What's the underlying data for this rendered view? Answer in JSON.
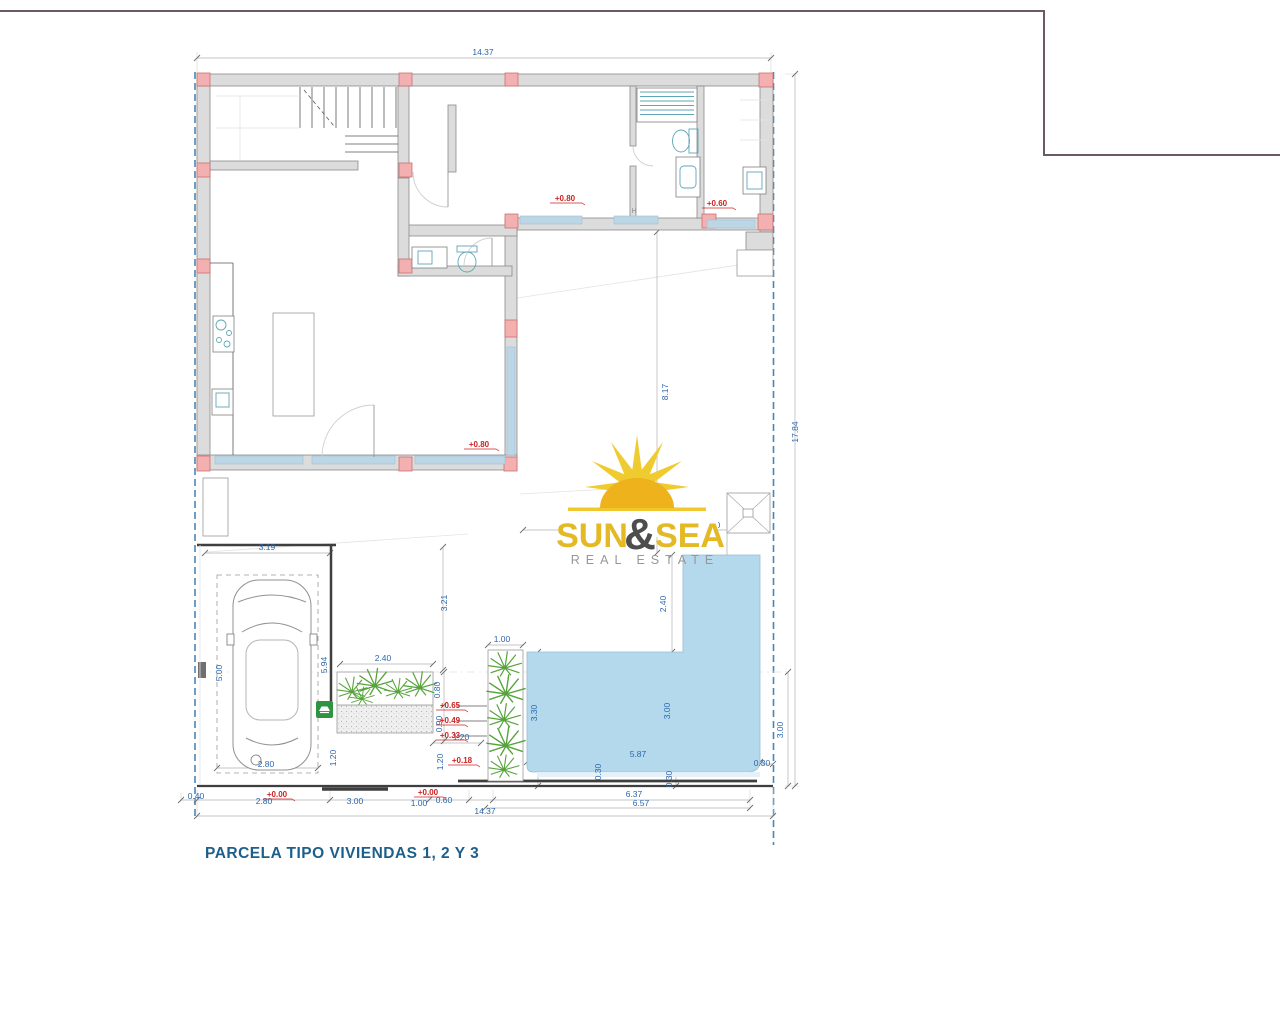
{
  "title": "PARCELA TIPO VIVIENDAS 1, 2 Y 3",
  "logo": {
    "word1": "SUN",
    "amp": "&",
    "word2": "SEA",
    "subtitle": "REAL ESTATE"
  },
  "note_h": "H",
  "dims": {
    "top_total": "14.37",
    "right_total": "17.84",
    "court_height": "8.17",
    "court_width": "4.01",
    "equip_width": "2.00",
    "pool_arm_height": "2.40",
    "garage_width": "3.19",
    "terrace_height": "3.21",
    "garage_depth": "5.00",
    "garage_wall": "5.94",
    "parking_width": "2.80",
    "planter_width": "2.40",
    "step_h1": "0.80",
    "step_h2": "0.90",
    "step_w": "1.20",
    "garage_gap": "1.20",
    "planter_gap": "1.20",
    "vplanter_width": "1.00",
    "pool_left": "3.30",
    "pool_mid": "3.00",
    "pool_width": "5.87",
    "pool_off1": "0.30",
    "pool_off2": "0.30",
    "pool_off_right": "0.30",
    "right_depth": "3.00",
    "b_040": "0.40",
    "b_280": "2.80",
    "b_300": "3.00",
    "b_100": "1.00",
    "b_060": "0.60",
    "b_637": "6.37",
    "b_657": "6.57",
    "bottom_total": "14.37"
  },
  "levels": {
    "lv_080_a": "+0.80",
    "lv_060": "+0.60",
    "lv_080_b": "+0.80",
    "lv_065": "+0.65",
    "lv_049": "+0.49",
    "lv_033": "+0.33",
    "lv_018": "+0.18",
    "lv_000_a": "+0.00",
    "lv_000_b": "+0.00"
  },
  "colors": {
    "dim_blue": "#2b66ad",
    "red_level": "#cc2222",
    "boundary_blue": "#4a86b8",
    "wall_fill": "#dcdcdc",
    "wall_stroke": "#8a8a8a",
    "column_fill": "#f2b0b0",
    "column_stroke": "#cf6f6f",
    "pool_fill": "#b5d9ec",
    "window_blue": "#bcd6e6",
    "logo_gold": "#e3ba25",
    "logo_amp": "#4d4d4d",
    "logo_gray": "#979797",
    "title_color": "#1c5f8a",
    "frame_line": "#6a5a66",
    "plant_green": "#57a33b"
  }
}
